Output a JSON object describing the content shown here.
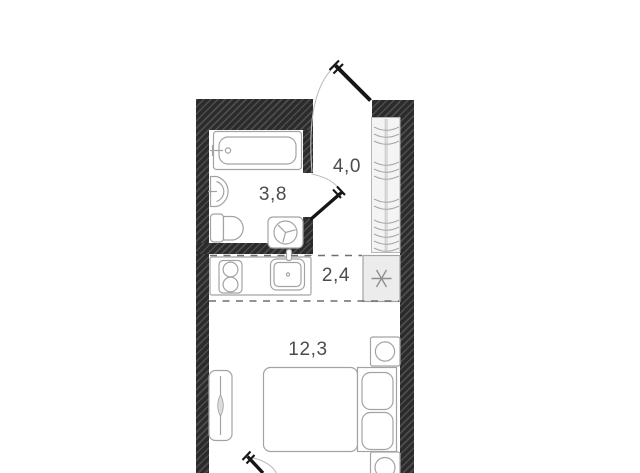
{
  "floorplan": {
    "type": "studio-apartment-floor-plan",
    "rooms": [
      {
        "name": "bathroom",
        "area_label": "3,8"
      },
      {
        "name": "hallway",
        "area_label": "4,0"
      },
      {
        "name": "kitchen",
        "area_label": "2,4"
      },
      {
        "name": "living-room",
        "area_label": "12,3"
      }
    ],
    "fixtures": [
      "bathtub",
      "wash-basin",
      "toilet",
      "washing-machine",
      "stove-two-burners",
      "kitchen-sink",
      "ventilation-shaft",
      "hallway-wardrobe-with-hangers",
      "double-bed-with-pillows",
      "nightstand-top",
      "nightstand-bottom",
      "cabinet",
      "entrance-door",
      "bathroom-door",
      "balcony-door"
    ],
    "colors": {
      "background": "#ffffff",
      "wall": "#2b2b2b",
      "wall_hatch": "#4a4a4a",
      "fixture_outline": "#a3a3a3",
      "fixture_fill_light": "#ececec",
      "label_text": "#4c4c4c",
      "door_leaf": "#161616",
      "zone_dash": "#6f6f6f"
    }
  }
}
